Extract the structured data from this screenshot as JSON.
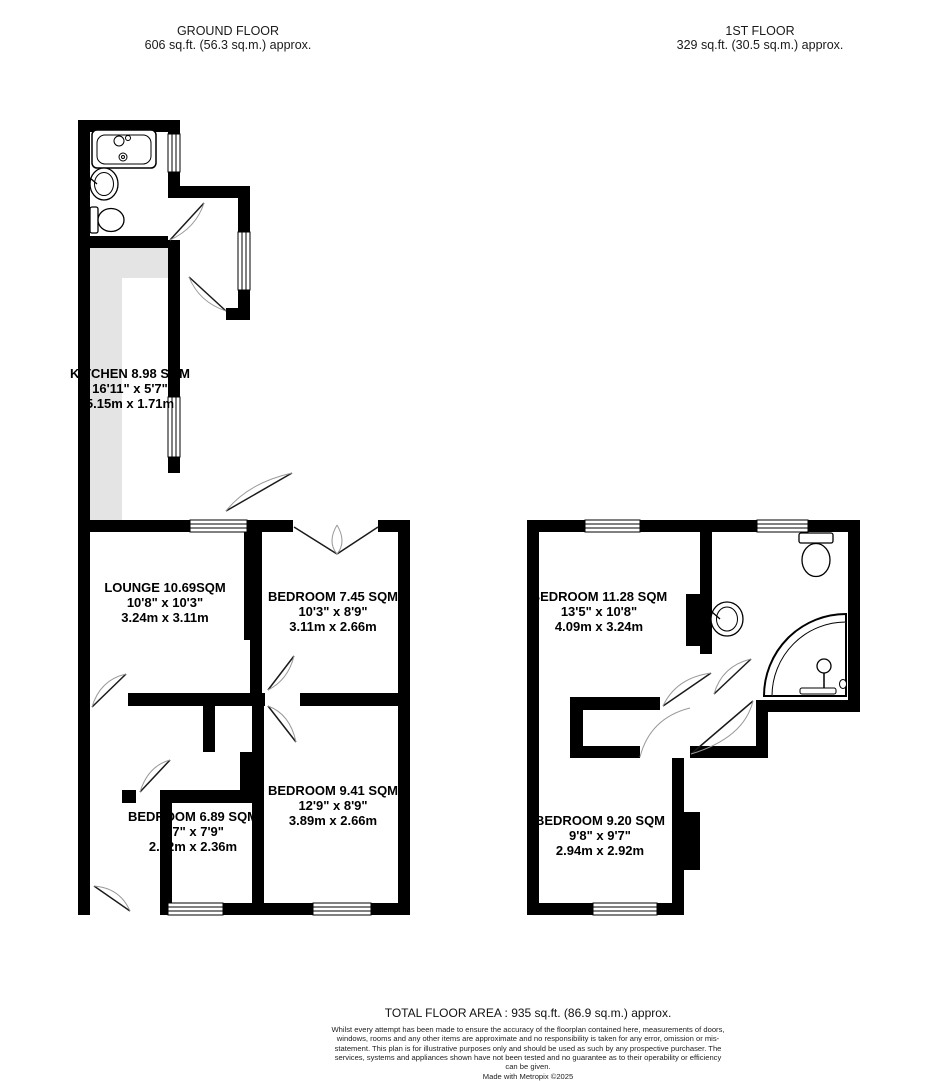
{
  "floors": {
    "ground": {
      "title": "GROUND FLOOR",
      "area": "606 sq.ft. (56.3 sq.m.) approx."
    },
    "first": {
      "title": "1ST FLOOR",
      "area": "329 sq.ft. (30.5 sq.m.) approx."
    }
  },
  "rooms": {
    "kitchen": {
      "name": "KITCHEN 8.98 SQM",
      "imperial": "16'11\"  x 5'7\"",
      "metric": "5.15m  x 1.71m"
    },
    "lounge": {
      "name": "LOUNGE 10.69SQM",
      "imperial": "10'8\"  x 10'3\"",
      "metric": "3.24m  x 3.11m"
    },
    "bedroom1": {
      "name": "BEDROOM 7.45 SQM",
      "imperial": "10'3\"  x 8'9\"",
      "metric": "3.11m  x 2.66m"
    },
    "bedroom2": {
      "name": "BEDROOM 9.41 SQM",
      "imperial": "12'9\"  x 8'9\"",
      "metric": "3.89m  x 2.66m"
    },
    "bedroom3": {
      "name": "BEDROOM 6.89 SQM",
      "imperial": "9'7\"  x 7'9\"",
      "metric": "2.92m  x 2.36m"
    },
    "bedroom4": {
      "name": "BEDROOM 11.28 SQM",
      "imperial": "13'5\"  x 10'8\"",
      "metric": "4.09m  x 3.24m"
    },
    "bedroom5": {
      "name": "BEDROOM 9.20 SQM",
      "imperial": "9'8\"  x 9'7\"",
      "metric": "2.94m  x 2.92m"
    }
  },
  "footer": {
    "total": "TOTAL FLOOR AREA : 935 sq.ft. (86.9 sq.m.) approx.",
    "disclaimer": "Whilst every attempt has been made to ensure the accuracy of the floorplan contained here, measurements of doors, windows, rooms and any other items are approximate and no responsibility is taken for any error, omission or mis-statement. This plan is for illustrative purposes only and should be used as such by any prospective purchaser. The services, systems and appliances shown have not been tested and no guarantee as to their operability or efficiency can be given.",
    "credit": "Made with Metropix ©2025"
  },
  "colors": {
    "wall": "#000000",
    "kitchen_floor": "#e4e4e4",
    "background": "#ffffff"
  }
}
